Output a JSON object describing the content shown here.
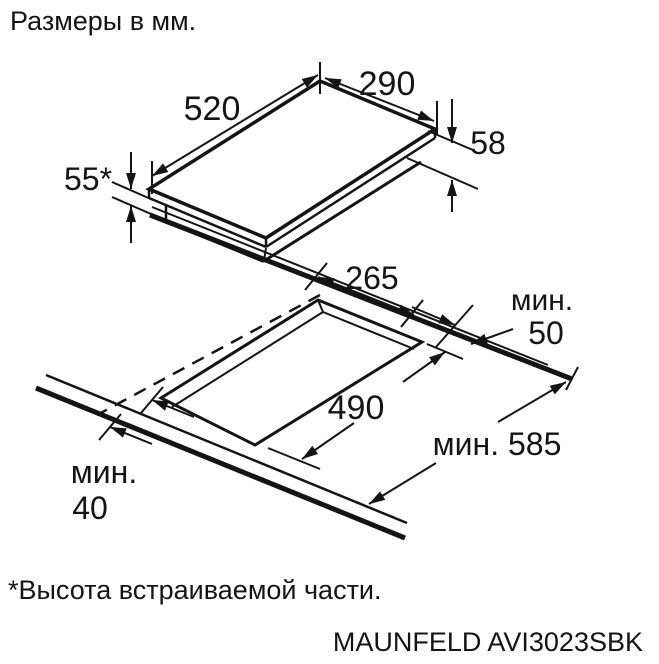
{
  "header": {
    "title": "Размеры в мм."
  },
  "footer": {
    "note": "*Высота встраиваемой части.",
    "model": "MAUNFELD AVI3023SBK"
  },
  "dimensions_mm": {
    "hob_length": 520,
    "hob_width": 290,
    "total_height": 58,
    "built_in_height": "55*",
    "cutout_width": 265,
    "cutout_length": 490,
    "min_rear_clearance": 50,
    "min_counter_depth": 585,
    "min_front_clearance": 40
  },
  "diagram": {
    "ink": "#141414",
    "bg": "#ffffff",
    "polygons": [
      {
        "name": "hob-glass-top",
        "points": [
          320,
          81,
          435,
          129,
          266,
          238,
          149,
          189
        ],
        "w": 3.5
      },
      {
        "name": "cutout-opening",
        "points": [
          318,
          300,
          422,
          342,
          255,
          445,
          161,
          398
        ],
        "w": 3
      }
    ],
    "segments": [
      {
        "name": "glass-left-edge",
        "d": [
          149,
          189,
          149,
          198
        ],
        "w": 2.5
      },
      {
        "name": "glass-bottom-left",
        "d": [
          149,
          198,
          266,
          247
        ],
        "w": 2.5
      },
      {
        "name": "glass-corner",
        "d": [
          266,
          238,
          266,
          247
        ],
        "w": 2.5
      },
      {
        "name": "glass-bottom-right",
        "d": [
          266,
          247,
          435,
          138
        ],
        "w": 2.5
      },
      {
        "name": "glass-right-edge",
        "d": [
          435,
          129,
          435,
          138
        ],
        "w": 2.5
      },
      {
        "name": "body-left-edge",
        "d": [
          166,
          205,
          166,
          221
        ],
        "w": 2.5
      },
      {
        "name": "body-bottom-left",
        "d": [
          166,
          221,
          264,
          261
        ],
        "w": 4
      },
      {
        "name": "body-corner",
        "d": [
          264,
          261,
          266,
          248
        ],
        "w": 2
      },
      {
        "name": "body-bottom-right",
        "d": [
          264,
          261,
          421,
          162
        ],
        "w": 3
      },
      {
        "name": "tick-top-corner",
        "d": [
          320,
          62,
          320,
          94
        ],
        "w": 2
      },
      {
        "name": "tick-left-corner",
        "d": [
          152,
          161,
          152,
          194
        ],
        "w": 2
      },
      {
        "name": "tick-right-corner",
        "d": [
          437,
          101,
          437,
          134
        ],
        "w": 2
      },
      {
        "name": "ref-55-upper",
        "d": [
          112,
          182,
          153,
          200
        ],
        "w": 2
      },
      {
        "name": "ref-55-lower",
        "d": [
          112,
          197,
          151,
          214
        ],
        "w": 2
      },
      {
        "name": "ref-58-upper",
        "d": [
          428,
          131,
          473,
          150
        ],
        "w": 2
      },
      {
        "name": "ref-58-lower",
        "d": [
          407,
          158,
          478,
          189
        ],
        "w": 2
      },
      {
        "name": "counter-back-thin",
        "d": [
          152,
          207,
          548,
          365
        ],
        "w": 2
      },
      {
        "name": "counter-back-thick",
        "d": [
          150,
          215,
          572,
          379
        ],
        "w": 5
      },
      {
        "name": "counter-back-end-tick",
        "d": [
          566,
          390,
          578,
          367
        ],
        "w": 2
      },
      {
        "name": "counter-front-thin",
        "d": [
          46,
          375,
          407,
          523
        ],
        "w": 2.5
      },
      {
        "name": "counter-front-thick",
        "d": [
          36,
          388,
          405,
          538
        ],
        "w": 5
      },
      {
        "name": "hidden-line",
        "d": [
          320,
          295,
          97,
          415
        ],
        "w": 2.5,
        "dash": "13,9"
      },
      {
        "name": "cutout-depth-corner",
        "d": [
          318,
          300,
          323,
          312
        ],
        "w": 2
      },
      {
        "name": "cutout-depth-right",
        "d": [
          323,
          312,
          414,
          349
        ],
        "w": 2
      },
      {
        "name": "cutout-depth-left",
        "d": [
          323,
          312,
          172,
          407
        ],
        "w": 2
      },
      {
        "name": "tick-265-left",
        "d": [
          327,
          263,
          305,
          290
        ],
        "w": 2
      },
      {
        "name": "tick-265-right",
        "d": [
          423,
          300,
          401,
          327
        ],
        "w": 2
      },
      {
        "name": "ext-min50",
        "d": [
          473,
          305,
          436,
          347
        ],
        "w": 2
      },
      {
        "name": "ext-490-lower",
        "d": [
          268,
          448,
          320,
          469
        ],
        "w": 2
      },
      {
        "name": "ext-490-upper",
        "d": [
          427,
          344,
          463,
          359
        ],
        "w": 2
      },
      {
        "name": "tick-min40-outer",
        "d": [
          121,
          414,
          99,
          440
        ],
        "w": 2
      },
      {
        "name": "tick-min40-inner",
        "d": [
          163,
          387,
          141,
          413
        ],
        "w": 2
      }
    ],
    "arrows": [
      {
        "name": "dim-520-line",
        "d": [
          152,
          176,
          318,
          75
        ],
        "heads": 2
      },
      {
        "name": "dim-290-line",
        "d": [
          325,
          78,
          434,
          121
        ],
        "heads": 2
      },
      {
        "name": "dim-55-top",
        "d": [
          131,
          152,
          131,
          189
        ],
        "heads": 1
      },
      {
        "name": "dim-55-bottom",
        "d": [
          131,
          243,
          131,
          206
        ],
        "heads": 1
      },
      {
        "name": "dim-58-top",
        "d": [
          452,
          99,
          452,
          143
        ],
        "heads": 1
      },
      {
        "name": "dim-58-bottom",
        "d": [
          452,
          212,
          452,
          180
        ],
        "heads": 1
      },
      {
        "name": "dim-265-line",
        "d": [
          318,
          277,
          414,
          315
        ],
        "heads": 2
      },
      {
        "name": "dim-min50-upper",
        "d": [
          412,
          307,
          455,
          325
        ],
        "heads": 1
      },
      {
        "name": "dim-min50-lower",
        "d": [
          513,
          329,
          471,
          344
        ],
        "heads": 1
      },
      {
        "name": "dim-490-lower",
        "d": [
          354,
          423,
          302,
          459
        ],
        "heads": 1
      },
      {
        "name": "dim-490-upper",
        "d": [
          403,
          382,
          445,
          352
        ],
        "heads": 1
      },
      {
        "name": "dim-min585-upper",
        "d": [
          498,
          422,
          566,
          382
        ],
        "heads": 1
      },
      {
        "name": "dim-min585-lower",
        "d": [
          436,
          463,
          369,
          504
        ],
        "heads": 1
      },
      {
        "name": "dim-min40-outer",
        "d": [
          152,
          444,
          110,
          427
        ],
        "heads": 1
      },
      {
        "name": "dim-min40-inner",
        "d": [
          194,
          417,
          152,
          400
        ],
        "heads": 1
      }
    ],
    "labels": [
      {
        "name": "dim-label-520",
        "text": "520",
        "x": 212,
        "y": 120,
        "s": 34,
        "a": "middle"
      },
      {
        "name": "dim-label-290",
        "text": "290",
        "x": 387,
        "y": 95,
        "s": 34,
        "a": "middle"
      },
      {
        "name": "dim-label-58",
        "text": "58",
        "x": 488,
        "y": 154,
        "s": 32,
        "a": "middle"
      },
      {
        "name": "dim-label-55",
        "text": "55*",
        "x": 88,
        "y": 190,
        "s": 32,
        "a": "middle"
      },
      {
        "name": "dim-label-265",
        "text": "265",
        "x": 372,
        "y": 289,
        "s": 32,
        "a": "middle"
      },
      {
        "name": "dim-label-min50-word",
        "text": "мин.",
        "x": 542,
        "y": 310,
        "s": 30,
        "a": "middle"
      },
      {
        "name": "dim-label-min50-num",
        "text": "50",
        "x": 546,
        "y": 344,
        "s": 32,
        "a": "middle"
      },
      {
        "name": "dim-label-490",
        "text": "490",
        "x": 356,
        "y": 419,
        "s": 34,
        "a": "middle"
      },
      {
        "name": "dim-label-min585",
        "text": "мин. 585",
        "x": 497,
        "y": 455,
        "s": 32,
        "a": "middle"
      },
      {
        "name": "dim-label-min40-word",
        "text": "мин.",
        "x": 104,
        "y": 483,
        "s": 32,
        "a": "middle"
      },
      {
        "name": "dim-label-min40-num",
        "text": "40",
        "x": 90,
        "y": 519,
        "s": 32,
        "a": "middle"
      }
    ]
  }
}
